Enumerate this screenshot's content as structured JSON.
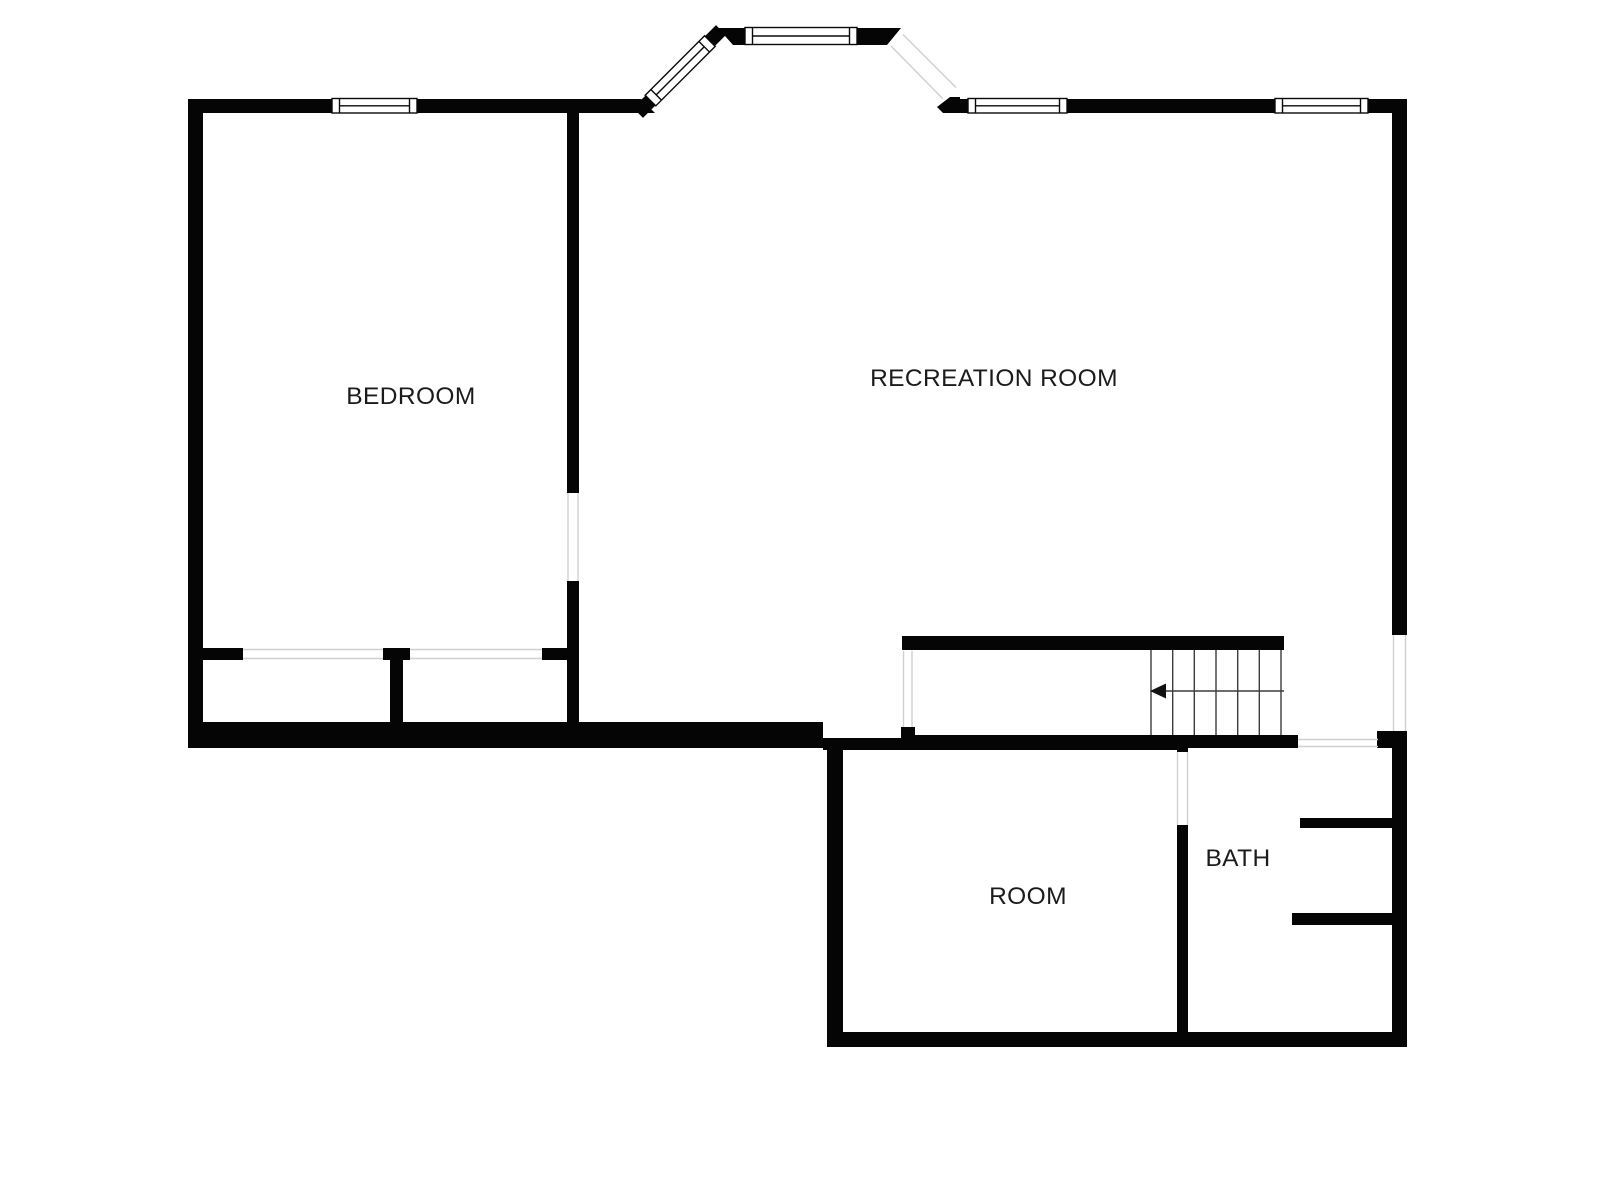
{
  "plan": {
    "rooms": [
      {
        "name": "BEDROOM"
      },
      {
        "name": "RECREATION ROOM"
      },
      {
        "name": "ROOM"
      },
      {
        "name": "BATH"
      }
    ],
    "stairs": {
      "tread_count": 6,
      "arrow_direction": "left"
    },
    "colors": {
      "wall": "#050505",
      "label_text": "#1b1b1b",
      "opening_line": "#cfcfcf",
      "floor": "#ffffff"
    }
  }
}
